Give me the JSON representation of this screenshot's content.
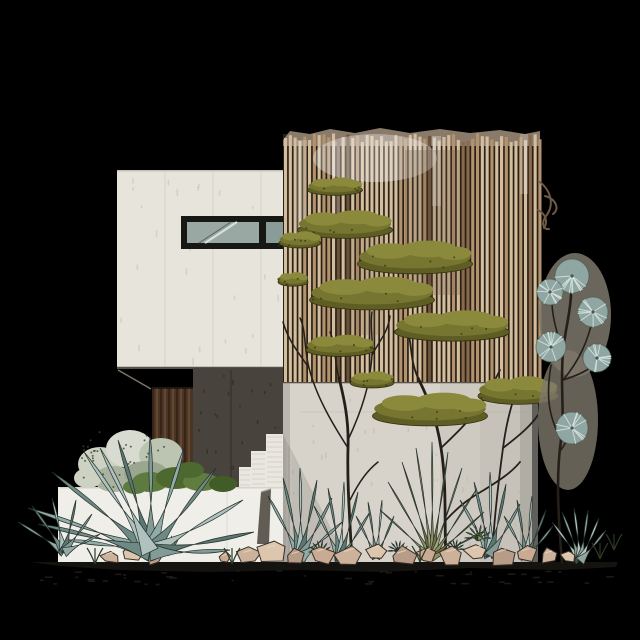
{
  "scene": {
    "description": "Architectural elevation illustration of a modern minimalist house: white concrete upper volume with ribbon window, tall vertical wood-slat screen wall with climbing olive-green tree canopies, dark charcoal entry recess with wood slat door, concrete stairs, white planter wall, desert garden of agaves, yucca, succulents and rocks, bare sketch trees, and a silvery puffball shrub tree on black background",
    "background": "#000000",
    "palette": {
      "bg": "#000000",
      "wall_white": "#e7e4dc",
      "wall_seam": "#d2cec4",
      "soffit_line": "#56524a",
      "window_frame": "#171714",
      "window_glass": "#9aa8a3",
      "window_glass_dark": "#8a9c97",
      "glass_streak_light": "#d9dfda",
      "glass_streak_dark": "#5f6c68",
      "slat_gap": "#2b2015",
      "slat_light": "#d2bd9e",
      "slat_mid": "#b2936e",
      "slat_brown": "#8a6a4c",
      "slat_dark": "#6b523a",
      "slat_band": "#8a7a6a",
      "charcoal_wall": "#48443d",
      "charcoal_seam": "#37342d",
      "charcoal_speck": "#302c26",
      "recess_edge": "#8d897f",
      "door_wood": "#4a3424",
      "door_plank_dark": "#2c1d12",
      "door_plank_light": "#73533a",
      "lower_wall": "#d7d3ca",
      "lower_wall_speck": "#b9b4a8",
      "stair_white": "#e9e7e0",
      "stair_line": "#c6c2b8",
      "planter_wall": "#efeee9",
      "fin_wall": "#615d54",
      "edge_grey": "#8e8a80",
      "ground_dark": "#14130f",
      "speckle": "#1e1d17",
      "trunk": "#241f19",
      "canopy_base": "#5e5d24",
      "canopy_mid": "#777630",
      "canopy_top": "#8b8a3c",
      "canopy_outline": "#2f2f10",
      "sage_pale": [
        "#cdd2c3",
        "#d8dcd0",
        "#bcc4b2",
        "#a9b39f",
        "#9aa690"
      ],
      "sage_dot": "#3c4434",
      "shrub_green": [
        "#5d7a3f",
        "#4e692f",
        "#607c3e",
        "#425c28"
      ],
      "agave": [
        "#93aba6",
        "#6f8a85",
        "#b0c2be",
        "#5d7672",
        "#829b96"
      ],
      "agave_outline": "#23302c",
      "yucca": [
        "#8f8f5e",
        "#6f7045",
        "#a3a372"
      ],
      "fan_succulent": [
        "#b9c5be",
        "#93a49d"
      ],
      "rosette_colors": [
        "#a9b05c",
        "#9aa84f",
        "#5f7c3f",
        "#587538",
        "#61803f"
      ],
      "rock": [
        "#cdb29b",
        "#dcc6ae",
        "#b79d88",
        "#c8ab92"
      ],
      "rock_outline": "#3a2f26",
      "rock_highlight": "#ead9c4",
      "puff_back": "#7e786c",
      "puff_ball": "#8fa6a2",
      "puff_streak": "#d9e4e0",
      "puff_edge": "#46564f",
      "vine_brown": "#6d5945",
      "grass_dark": "#2c3a26"
    },
    "geometry": {
      "slat_screen": {
        "x0": 284,
        "x1": 539,
        "top_min": 133,
        "top_max": 142,
        "bottom": 383,
        "step": 4.8,
        "width": 3.1
      },
      "door_planks": {
        "x0": 153,
        "x1": 192,
        "y0": 388,
        "y1": 487,
        "step": 4
      },
      "canopies": [
        [
          335,
          190,
          55,
          14
        ],
        [
          345,
          230,
          95,
          22
        ],
        [
          300,
          243,
          42,
          13
        ],
        [
          415,
          264,
          115,
          26
        ],
        [
          293,
          282,
          30,
          11
        ],
        [
          372,
          300,
          125,
          26
        ],
        [
          340,
          350,
          68,
          17
        ],
        [
          452,
          332,
          115,
          24
        ],
        [
          372,
          383,
          44,
          13
        ],
        [
          430,
          416,
          115,
          26
        ],
        [
          518,
          396,
          80,
          22
        ]
      ],
      "puffballs": [
        [
          572,
          276,
          17
        ],
        [
          550,
          292,
          13
        ],
        [
          593,
          312,
          15
        ],
        [
          551,
          347,
          15
        ],
        [
          597,
          358,
          14
        ],
        [
          572,
          428,
          16
        ]
      ],
      "puff_branches": [
        "M562,562 C558,515 556,475 561,440 C565,412 560,385 563,352 C565,330 570,315 571,295",
        "M561,440 C548,415 546,395 551,365",
        "M563,380 C582,374 592,368 596,362",
        "M563,352 C556,330 552,315 552,302",
        "M571,295 C570,288 571,284 572,280",
        "M563,380 C580,360 588,340 593,318",
        "M561,450 C566,442 570,436 572,430"
      ],
      "bare_tree": [
        "M352,562 C350,520 347,485 348,448 C349,420 344,398 339,378",
        "M348,448 C330,420 316,395 309,368 C304,348 306,330 300,318",
        "M309,368 C298,352 288,340 283,322",
        "M348,440 C362,410 370,385 372,355 C373,338 370,325 372,312",
        "M372,355 C380,340 388,332 390,316",
        "M339,378 C334,360 336,345 330,332",
        "M350,500 C360,480 368,470 378,462"
      ],
      "canopy_trunks": [
        "M446,560 C444,520 447,485 441,448 C437,420 428,398 418,378",
        "M441,448 C460,430 472,418 482,402",
        "M446,520 C460,505 470,498 484,490 C500,480 512,472 520,462",
        "M492,558 C494,520 498,485 503,448 C506,425 510,410 514,398",
        "M503,448 C520,435 532,425 540,412",
        "M418,378 C410,360 412,345 408,332",
        "M482,402 C490,390 494,382 500,370"
      ],
      "vine": [
        "M540,182 C552,192 554,206 546,216 C541,223 543,230 549,229",
        "M545,196 C556,199 560,209 553,214",
        "M538,210 C546,214 548,222 544,228"
      ],
      "sage_blobs": [
        [
          100,
          464,
          22,
          17
        ],
        [
          130,
          449,
          24,
          19
        ],
        [
          161,
          455,
          22,
          17
        ],
        [
          114,
          479,
          20,
          13
        ],
        [
          146,
          474,
          22,
          13
        ],
        [
          88,
          478,
          14,
          10
        ]
      ],
      "shrub_blobs": [
        [
          150,
          482,
          18,
          10
        ],
        [
          176,
          478,
          20,
          11
        ],
        [
          201,
          482,
          18,
          9
        ],
        [
          223,
          484,
          14,
          8
        ],
        [
          135,
          487,
          12,
          7
        ],
        [
          190,
          470,
          14,
          8
        ]
      ],
      "big_agave": {
        "base": [
          150,
          552
        ],
        "w": 9,
        "tips": [
          [
            28,
            508
          ],
          [
            52,
            472
          ],
          [
            84,
            452
          ],
          [
            118,
            440
          ],
          [
            150,
            436
          ],
          [
            184,
            448
          ],
          [
            216,
            468
          ],
          [
            243,
            500
          ],
          [
            254,
            532
          ],
          [
            230,
            550
          ],
          [
            66,
            540
          ],
          [
            38,
            524
          ],
          [
            100,
            448
          ]
        ]
      },
      "small_agave": {
        "base": [
          64,
          552
        ],
        "w": 5,
        "tips": [
          [
            18,
            522
          ],
          [
            32,
            506
          ],
          [
            52,
            498
          ],
          [
            76,
            500
          ],
          [
            92,
            514
          ],
          [
            100,
            534
          ]
        ]
      },
      "row_agaves": [
        {
          "base": [
            300,
            558
          ],
          "w": 6,
          "tips": [
            [
              268,
              496
            ],
            [
              283,
              478
            ],
            [
              300,
              468
            ],
            [
              317,
              480
            ],
            [
              332,
              498
            ],
            [
              342,
              522
            ]
          ]
        },
        {
          "base": [
            340,
            560
          ],
          "w": 5,
          "tips": [
            [
              314,
              506
            ],
            [
              328,
              488
            ],
            [
              344,
              482
            ],
            [
              358,
              492
            ],
            [
              370,
              512
            ]
          ]
        },
        {
          "base": [
            376,
            558
          ],
          "w": 4,
          "tips": [
            [
              356,
              516
            ],
            [
              368,
              502
            ],
            [
              382,
              500
            ],
            [
              394,
              516
            ]
          ]
        },
        {
          "base": [
            490,
            556
          ],
          "w": 6,
          "tips": [
            [
              460,
              500
            ],
            [
              474,
              482
            ],
            [
              490,
              472
            ],
            [
              506,
              484
            ],
            [
              520,
              504
            ]
          ]
        },
        {
          "base": [
            526,
            558
          ],
          "w": 5,
          "tips": [
            [
              504,
              516
            ],
            [
              517,
              500
            ],
            [
              532,
              496
            ],
            [
              546,
              510
            ],
            [
              553,
              526
            ]
          ]
        }
      ],
      "yucca": {
        "base": [
          432,
          558
        ],
        "w": 3,
        "tips": [
          [
            388,
            482
          ],
          [
            402,
            462
          ],
          [
            416,
            448
          ],
          [
            432,
            442
          ],
          [
            448,
            452
          ],
          [
            462,
            468
          ],
          [
            476,
            490
          ],
          [
            484,
            512
          ],
          [
            380,
            510
          ],
          [
            486,
            530
          ]
        ]
      },
      "fan": {
        "base": [
          580,
          561
        ],
        "w": 5,
        "tips": [
          [
            552,
            522
          ],
          [
            562,
            512
          ],
          [
            574,
            508
          ],
          [
            588,
            510
          ],
          [
            599,
            518
          ],
          [
            606,
            530
          ]
        ]
      },
      "rosettes": [
        [
          168,
          552,
          16,
          0
        ],
        [
          478,
          538,
          13,
          1
        ],
        [
          320,
          552,
          11,
          2
        ],
        [
          398,
          551,
          10,
          3
        ],
        [
          455,
          549,
          9,
          4
        ]
      ],
      "rocks": [
        [
          110,
          557,
          10
        ],
        [
          132,
          553,
          12
        ],
        [
          155,
          558,
          9
        ],
        [
          225,
          558,
          8
        ],
        [
          248,
          556,
          12
        ],
        [
          272,
          552,
          14
        ],
        [
          296,
          557,
          11
        ],
        [
          322,
          555,
          13
        ],
        [
          350,
          556,
          15
        ],
        [
          376,
          552,
          12
        ],
        [
          402,
          557,
          13
        ],
        [
          427,
          554,
          11
        ],
        [
          452,
          556,
          14
        ],
        [
          477,
          552,
          12
        ],
        [
          502,
          556,
          13
        ],
        [
          526,
          554,
          11
        ],
        [
          549,
          556,
          10
        ],
        [
          569,
          557,
          8
        ]
      ],
      "grass_tufts": [
        [
          95,
          560
        ],
        [
          232,
          560
        ],
        [
          420,
          558
        ],
        [
          600,
          555
        ],
        [
          614,
          546
        ]
      ],
      "ground_poly": "M30,562 L618,562 L616,567 L560,570 L470,568 L380,572 L300,570 L210,572 L120,570 L60,566 Z"
    }
  }
}
